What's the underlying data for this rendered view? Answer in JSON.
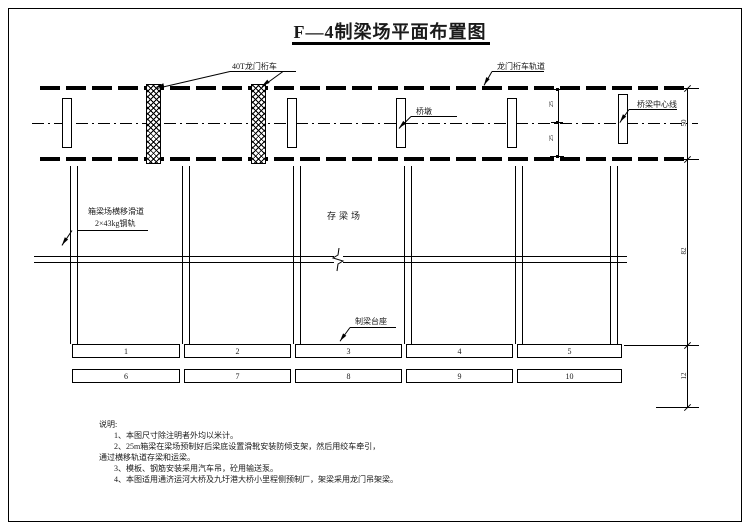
{
  "title": "F—4制梁场平面布置图",
  "labels": {
    "gantry_crane": "40T龙门桁车",
    "gantry_track": "龙门桁车轨道",
    "bridge_centerline": "桥梁中心线",
    "pier": "桥墩",
    "slideway_line1": "箱梁场横移滑道",
    "slideway_line2": "2×43kg钢轨",
    "storage_yard": "存梁场",
    "pedestal": "制梁台座"
  },
  "dimensions": {
    "rail_to_center_top": "25",
    "center_to_rail_bottom": "25",
    "rail_span": "50",
    "yard_length": "82",
    "tail_length": "12"
  },
  "pedestals": {
    "row1": [
      "1",
      "2",
      "3",
      "4",
      "5"
    ],
    "row2": [
      "6",
      "7",
      "8",
      "9",
      "10"
    ]
  },
  "notes": {
    "heading": "说明:",
    "lines": [
      "1、本图尺寸除注明者外均以米计。",
      "2、25m箱梁在梁场预制好后梁底设置滑靴安装防倾支架，然后用绞车牵引，",
      "通过横移轨道存梁和运梁。",
      "3、模板、钢筋安装采用汽车吊，砼用输送泵。",
      "4、本图适用通济运河大桥及九圩港大桥小里程侧预制厂，架梁采用龙门吊架梁。"
    ]
  }
}
